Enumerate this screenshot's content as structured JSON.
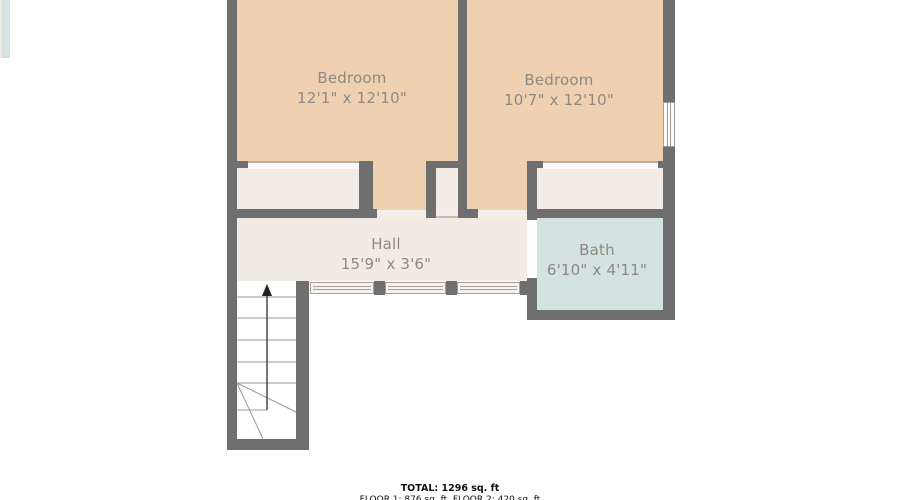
{
  "rooms": {
    "bedroom1": {
      "name": "Bedroom",
      "dims": "12'1\" x 12'10\""
    },
    "bedroom2": {
      "name": "Bedroom",
      "dims": "10'7\" x 12'10\""
    },
    "hall": {
      "name": "Hall",
      "dims": "15'9\" x 3'6\""
    },
    "bath": {
      "name": "Bath",
      "dims": "6'10\" x 4'11\""
    }
  },
  "footer": {
    "total": "TOTAL: 1296 sq. ft",
    "floors": "FLOOR 1: 876 sq. ft  FLOOR 2: 420 sq. ft"
  },
  "colors": {
    "wall": "#6f6f6f",
    "bedroom_fill": "#efd1b2",
    "closet_fill": "#f3ece5",
    "hall_fill": "#f2ebe4",
    "bath_fill": "#d4e2e1",
    "label_text": "#8d8983",
    "stair_line": "#9a9a9a",
    "arrow": "#2a2a2a"
  }
}
